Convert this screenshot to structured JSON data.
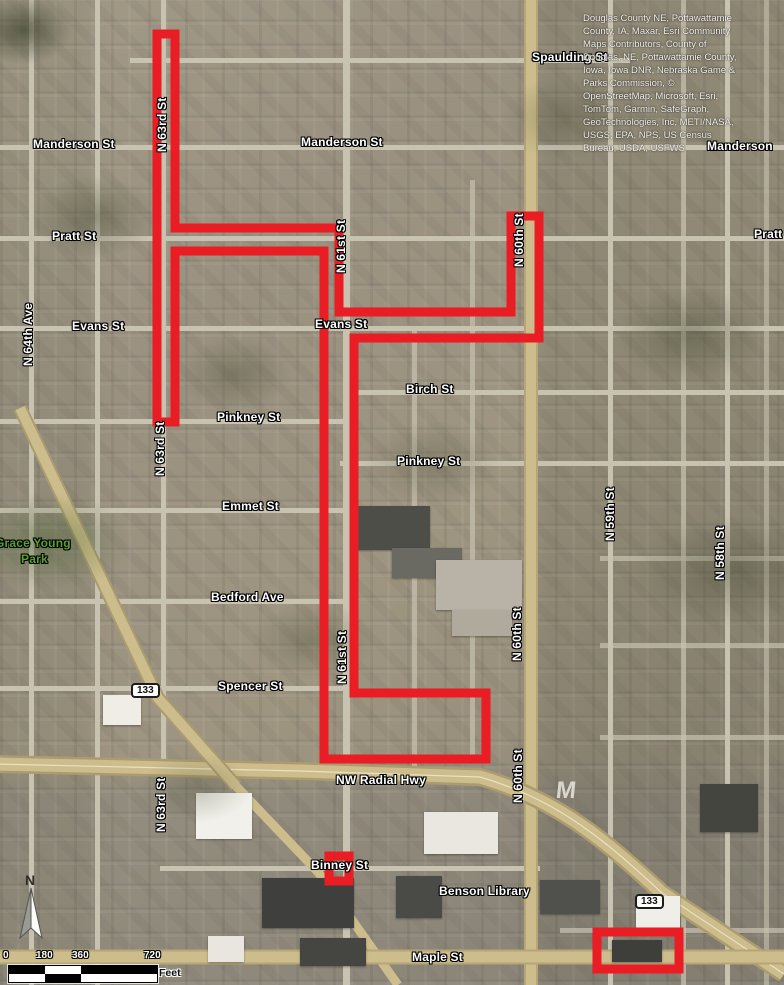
{
  "map": {
    "colors": {
      "route_red": "#ea1c24",
      "label_white": "#ffffff",
      "park_green": "#59a32d",
      "road_tan": "#c9b883"
    },
    "red_route": {
      "color": "#ea1c24",
      "stroke_width": 9,
      "polygon_points": "157,34 175,34 175,228 339,228 339,312 511,312 511,216 539,216 539,338 354,338 354,693 486,693 486,759 324,759 324,251 175,251 175,422 157,422",
      "binney_box": {
        "x": 329,
        "y": 856,
        "w": 20,
        "h": 25
      },
      "maple_box": {
        "x": 597,
        "y": 932,
        "w": 82,
        "h": 37
      }
    },
    "labels": [
      {
        "text": "Manderson St",
        "name": "street-label-manderson-west",
        "css": {
          "left": "33px",
          "top": "138px"
        }
      },
      {
        "text": "Manderson St",
        "name": "street-label-manderson-center",
        "css": {
          "left": "301px",
          "top": "136px"
        }
      },
      {
        "text": "Manderson",
        "name": "street-label-manderson-east",
        "css": {
          "left": "707px",
          "top": "140px"
        }
      },
      {
        "text": "Spaulding St",
        "name": "street-label-spaulding",
        "css": {
          "left": "532px",
          "top": "51px"
        }
      },
      {
        "text": "Pratt St",
        "name": "street-label-pratt-west",
        "css": {
          "left": "52px",
          "top": "230px"
        }
      },
      {
        "text": "Pratt",
        "name": "street-label-pratt-east",
        "css": {
          "left": "754px",
          "top": "228px"
        }
      },
      {
        "text": "Evans St",
        "name": "street-label-evans-west",
        "css": {
          "left": "72px",
          "top": "320px"
        }
      },
      {
        "text": "Evans St",
        "name": "street-label-evans-center",
        "css": {
          "left": "315px",
          "top": "318px"
        }
      },
      {
        "text": "Birch St",
        "name": "street-label-birch",
        "css": {
          "left": "406px",
          "top": "383px"
        }
      },
      {
        "text": "Pinkney St",
        "name": "street-label-pinkney-west",
        "css": {
          "left": "217px",
          "top": "411px"
        }
      },
      {
        "text": "Pinkney St",
        "name": "street-label-pinkney-east",
        "css": {
          "left": "397px",
          "top": "455px"
        }
      },
      {
        "text": "Emmet St",
        "name": "street-label-emmet",
        "css": {
          "left": "222px",
          "top": "500px"
        }
      },
      {
        "text": "Bedford Ave",
        "name": "street-label-bedford",
        "css": {
          "left": "211px",
          "top": "591px"
        }
      },
      {
        "text": "Spencer St",
        "name": "street-label-spencer",
        "css": {
          "left": "218px",
          "top": "680px"
        }
      },
      {
        "text": "NW Radial Hwy",
        "name": "street-label-nw-radial-hwy",
        "css": {
          "left": "336px",
          "top": "774px"
        }
      },
      {
        "text": "Binney St",
        "name": "street-label-binney",
        "css": {
          "left": "311px",
          "top": "859px"
        }
      },
      {
        "text": "Benson Library",
        "name": "poi-label-benson-library",
        "css": {
          "left": "439px",
          "top": "885px"
        }
      },
      {
        "text": "Maple St",
        "name": "street-label-maple",
        "css": {
          "left": "412px",
          "top": "951px"
        }
      },
      {
        "text": "Grace Young",
        "name": "park-label-grace-young",
        "cls": "park",
        "css": {
          "left": "-5px",
          "top": "537px"
        }
      },
      {
        "text": "Park",
        "name": "park-label-park",
        "cls": "park",
        "css": {
          "left": "21px",
          "top": "553px"
        }
      },
      {
        "text": "N 63rd St",
        "name": "street-label-n63rd-top",
        "cls": "vert",
        "css": {
          "left": "156px",
          "top": "152px"
        }
      },
      {
        "text": "N 63rd St",
        "name": "street-label-n63rd-mid",
        "cls": "vert",
        "css": {
          "left": "154px",
          "top": "476px"
        }
      },
      {
        "text": "N 63rd St",
        "name": "street-label-n63rd-south",
        "cls": "vert",
        "css": {
          "left": "155px",
          "top": "832px"
        }
      },
      {
        "text": "N 61st St",
        "name": "street-label-n61st-top",
        "cls": "vert",
        "css": {
          "left": "335px",
          "top": "273px"
        }
      },
      {
        "text": "N 61st St",
        "name": "street-label-n61st-mid",
        "cls": "vert",
        "css": {
          "left": "336px",
          "top": "684px"
        }
      },
      {
        "text": "N 60th St",
        "name": "street-label-n60th-top",
        "cls": "vert",
        "css": {
          "left": "513px",
          "top": "267px"
        }
      },
      {
        "text": "N 60th St",
        "name": "street-label-n60th-mid",
        "cls": "vert",
        "css": {
          "left": "511px",
          "top": "661px"
        }
      },
      {
        "text": "N 60th St",
        "name": "street-label-n60th-south",
        "cls": "vert",
        "css": {
          "left": "512px",
          "top": "803px"
        }
      },
      {
        "text": "N 59th St",
        "name": "street-label-n59th",
        "cls": "vert",
        "css": {
          "left": "604px",
          "top": "541px"
        }
      },
      {
        "text": "N 58th St",
        "name": "street-label-n58th",
        "cls": "vert",
        "css": {
          "left": "714px",
          "top": "580px"
        }
      },
      {
        "text": "N 64th Ave",
        "name": "street-label-n64th-ave",
        "cls": "vert",
        "css": {
          "left": "22px",
          "top": "366px"
        }
      },
      {
        "text": "M",
        "name": "gray-m-mark",
        "cls": "wm",
        "css": {
          "left": "556px",
          "top": "784px"
        }
      }
    ],
    "shields": [
      {
        "text": "133",
        "name": "highway-shield-133-west",
        "css": {
          "left": "131px",
          "top": "683px"
        }
      },
      {
        "text": "133",
        "name": "highway-shield-133-east",
        "css": {
          "left": "635px",
          "top": "894px"
        }
      }
    ],
    "attribution_lines": [
      {
        "text": "Douglas County NE, Pottawattamie"
      },
      {
        "text": "County, IA, Maxar, Esri Community"
      },
      {
        "text": "Maps Contributors, County of"
      },
      {
        "text": "Douglas, NE, Pottawattamie County,"
      },
      {
        "text": "Iowa, Iowa DNR, Nebraska Game &"
      },
      {
        "text": "Parks Commission, ©"
      },
      {
        "text": "OpenStreetMap, Microsoft, Esri,"
      },
      {
        "text": "TomTom, Garmin, SafeGraph,"
      },
      {
        "text": "GeoTechnologies, Inc, METI/NASA,"
      },
      {
        "text": "USGS, EPA, NPS, US Census"
      },
      {
        "text": "Bureau, USDA, USFWS"
      }
    ],
    "north_arrow": {
      "label": "N"
    },
    "scalebar": {
      "ticks": [
        {
          "text": "0",
          "css": {
            "left": "3px",
            "top": "950px"
          }
        },
        {
          "text": "180",
          "css": {
            "left": "36px",
            "top": "950px"
          }
        },
        {
          "text": "360",
          "css": {
            "left": "72px",
            "top": "950px"
          }
        },
        {
          "text": "720",
          "css": {
            "left": "144px",
            "top": "950px"
          }
        }
      ],
      "unit": "Feet"
    }
  }
}
